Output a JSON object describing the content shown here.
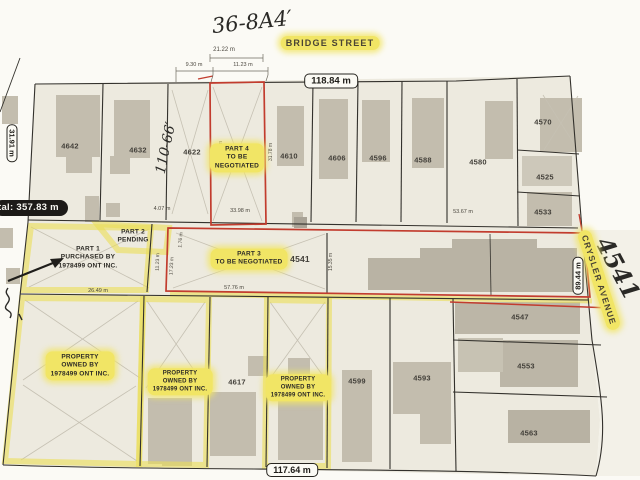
{
  "handwriting": {
    "plan_note": "36-8A4′",
    "lot_note": "4541",
    "depth_note": "110-66′"
  },
  "streets": {
    "top": "BRIDGE STREET",
    "right": "CRYSLER AVENUE"
  },
  "frame_labels": {
    "top_width": "118.84 m",
    "left_width": "31.91 m",
    "left_total": "tal: 357.83 m",
    "right_depth": "89.44 m",
    "bottom_width": "117.64 m"
  },
  "dims": {
    "bridge_frontage": "21.22 m",
    "west_split": "9.30 m",
    "east_split": "11.23 m",
    "gap": "4.07 m",
    "part4_bottom": "33.98 m",
    "part4_west": "32.73 m",
    "part4_east": "31.78 m",
    "east_block": "53.67 m",
    "part1_bottom": "26.49 m",
    "part1_east": "11.23 m",
    "part3_west": "17.23 m",
    "part3_jog": "1.76 m",
    "part3_mid": "15.35 m",
    "part3_bottom": "57.76 m"
  },
  "parts": {
    "part1": {
      "l1": "PART 1",
      "l2": "PURCHASED BY",
      "l3": "1978499 ONT INC."
    },
    "part2": {
      "l1": "PART 2",
      "l2": "PENDING"
    },
    "part3": {
      "l1": "PART 3",
      "l2": "TO BE NEGOTIATED",
      "lot": "4541"
    },
    "part4": {
      "l1": "PART 4",
      "l2": "TO BE",
      "l3": "NEGOTIATED"
    }
  },
  "owned": {
    "l1": "PROPERTY",
    "l2": "OWNED BY",
    "l3": "1978499 ONT INC."
  },
  "lots": {
    "north": [
      "4642",
      "4632",
      "4622",
      "4610",
      "4606",
      "4596",
      "4588",
      "4580"
    ],
    "east": [
      "4570",
      "4525",
      "4533"
    ],
    "south": [
      "4617",
      "4599",
      "4593",
      "4547",
      "4553",
      "4563"
    ]
  }
}
